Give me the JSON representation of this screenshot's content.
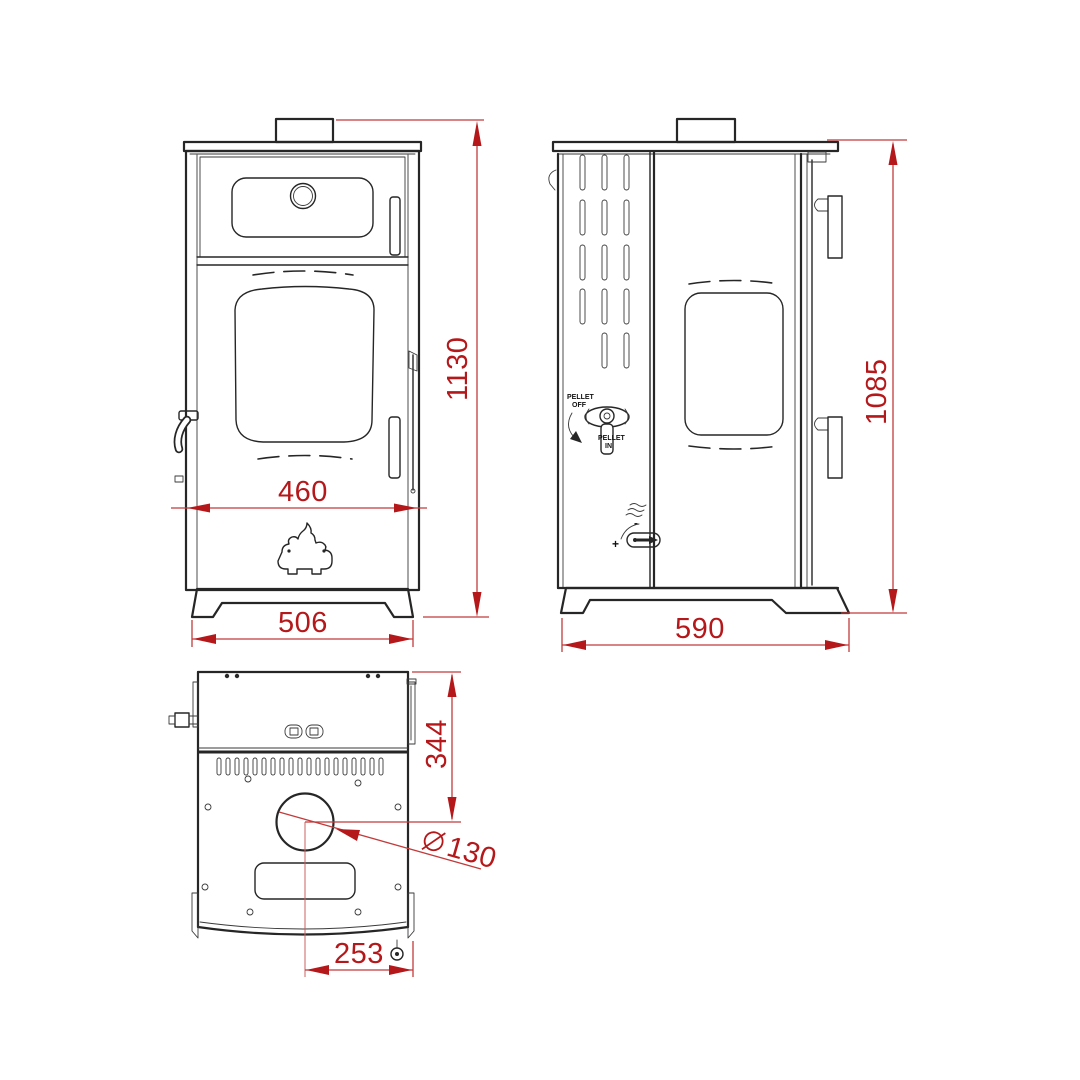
{
  "drawing_subject": "pellet-stove-dimensional-drawing",
  "colors": {
    "dimension": "#b5181a",
    "line": "#262626",
    "background": "#ffffff"
  },
  "front_view": {
    "height": "1130",
    "body_width": "460",
    "base_width": "506"
  },
  "side_view": {
    "height": "1085",
    "depth": "590",
    "pellet_switch": {
      "off_line1": "PELLET",
      "off_line2": "OFF",
      "in_line1": "PELLET",
      "in_line2": "IN"
    },
    "air_control": {
      "plus": "+",
      "minus": "-"
    }
  },
  "top_view": {
    "flue_offset_back": "344",
    "flue_diameter": "130",
    "flue_offset_side": "253"
  }
}
